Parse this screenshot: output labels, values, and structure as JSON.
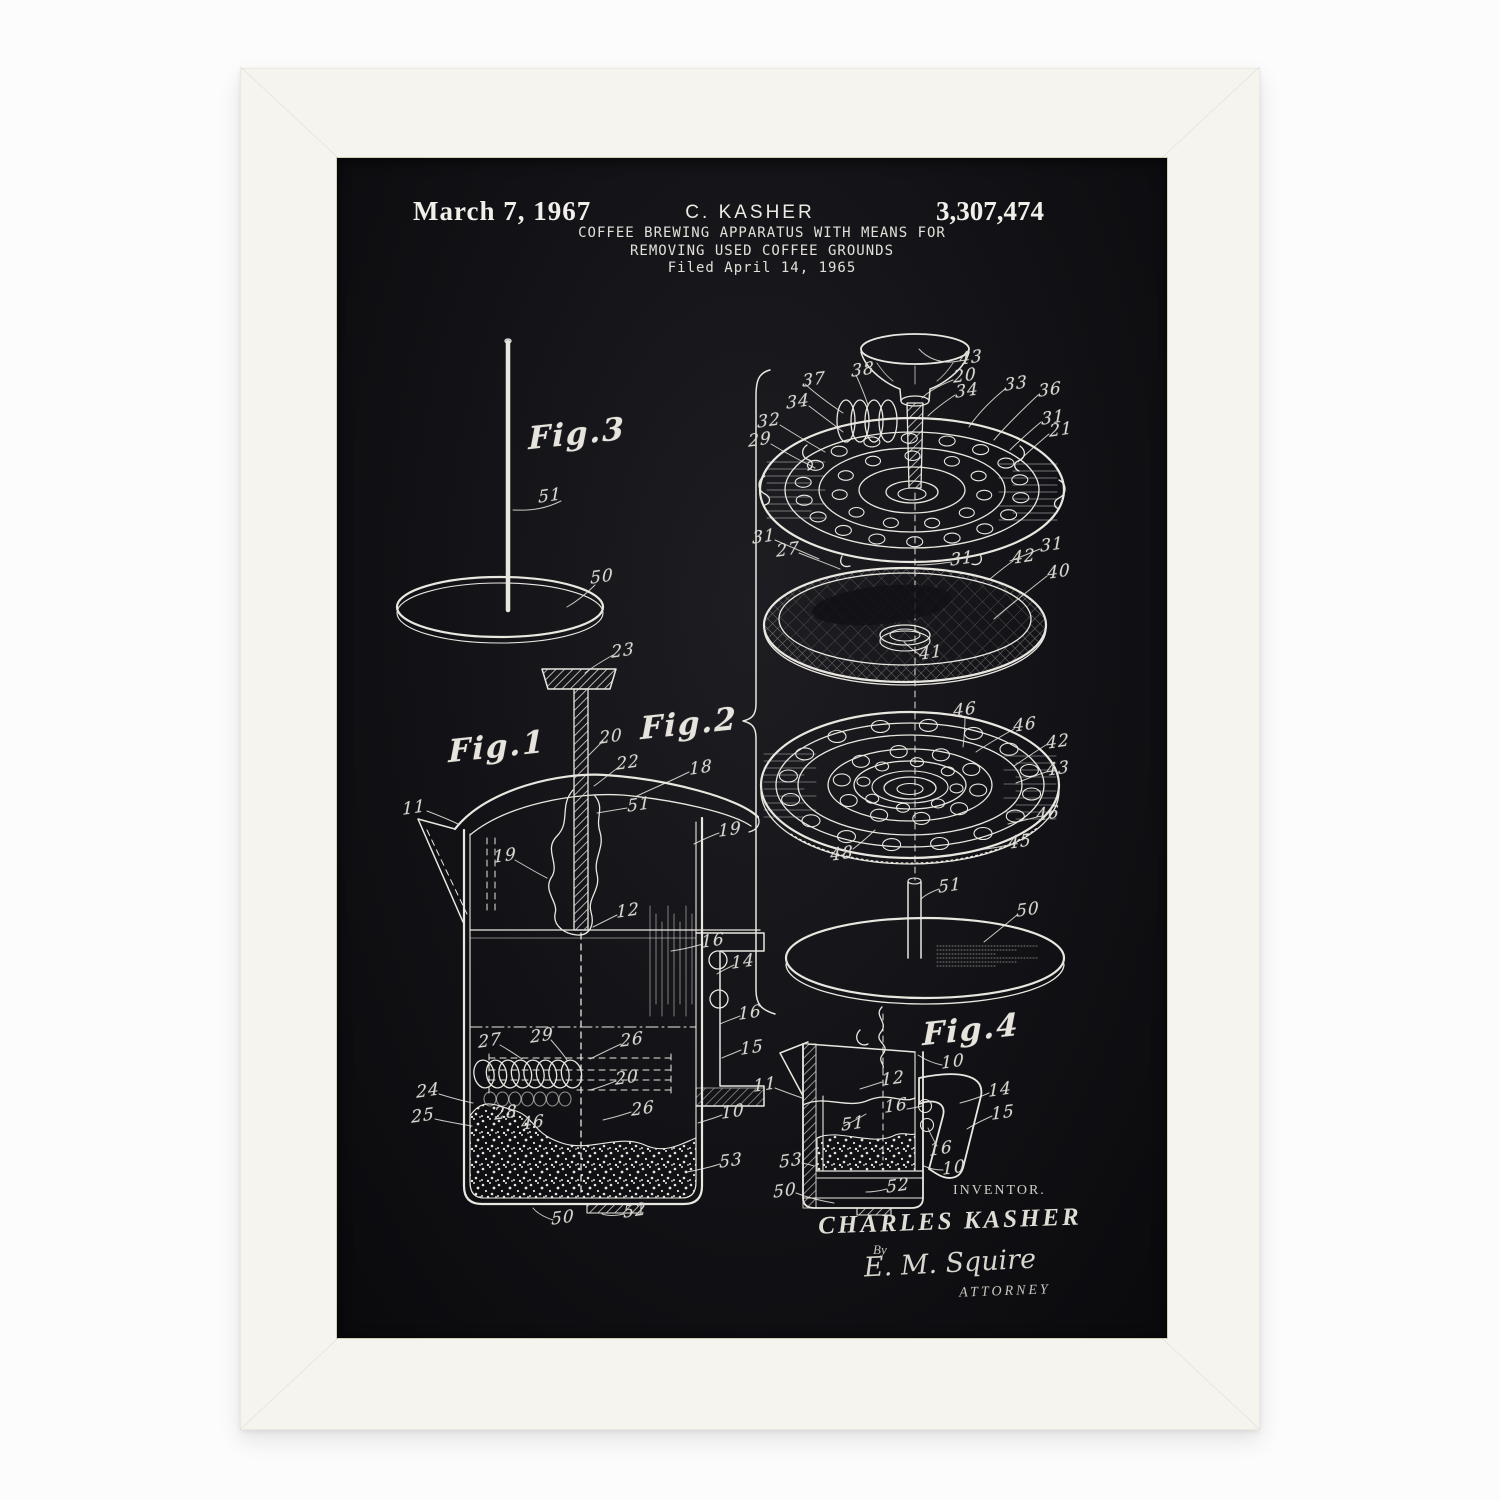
{
  "colors": {
    "page_bg": "#fcfcfc",
    "frame": "#f6f4ee",
    "poster_bg": "#101014",
    "line": "#e9e7e0"
  },
  "header": {
    "date": "March 7, 1967",
    "inventor": "C. KASHER",
    "patent_number": "3,307,474",
    "title_line1": "COFFEE BREWING APPARATUS WITH MEANS FOR",
    "title_line2": "REMOVING USED COFFEE GROUNDS",
    "filed": "Filed April 14, 1965"
  },
  "fig_captions": [
    {
      "text": "Fig.3",
      "x": 240,
      "y": 276
    },
    {
      "text": "Fig.1",
      "x": 160,
      "y": 589
    },
    {
      "text": "Fig.2",
      "x": 352,
      "y": 566
    },
    {
      "text": "Fig.4",
      "x": 634,
      "y": 872
    }
  ],
  "part_labels": [
    {
      "text": "51",
      "x": 213,
      "y": 338
    },
    {
      "text": "50",
      "x": 265,
      "y": 419
    },
    {
      "text": "23",
      "x": 286,
      "y": 493
    },
    {
      "text": "20",
      "x": 274,
      "y": 579
    },
    {
      "text": "22",
      "x": 291,
      "y": 605
    },
    {
      "text": "18",
      "x": 364,
      "y": 610
    },
    {
      "text": "11",
      "x": 77,
      "y": 650
    },
    {
      "text": "51",
      "x": 302,
      "y": 647
    },
    {
      "text": "19",
      "x": 168,
      "y": 698
    },
    {
      "text": "19",
      "x": 393,
      "y": 672
    },
    {
      "text": "12",
      "x": 291,
      "y": 753
    },
    {
      "text": "16",
      "x": 376,
      "y": 783
    },
    {
      "text": "14",
      "x": 406,
      "y": 804
    },
    {
      "text": "16",
      "x": 413,
      "y": 855
    },
    {
      "text": "15",
      "x": 415,
      "y": 890
    },
    {
      "text": "27",
      "x": 153,
      "y": 883
    },
    {
      "text": "29",
      "x": 205,
      "y": 878
    },
    {
      "text": "26",
      "x": 295,
      "y": 882
    },
    {
      "text": "20",
      "x": 290,
      "y": 920
    },
    {
      "text": "26",
      "x": 306,
      "y": 951
    },
    {
      "text": "24",
      "x": 91,
      "y": 933
    },
    {
      "text": "25",
      "x": 86,
      "y": 958
    },
    {
      "text": "28",
      "x": 169,
      "y": 955
    },
    {
      "text": "46",
      "x": 196,
      "y": 965
    },
    {
      "text": "10",
      "x": 396,
      "y": 954
    },
    {
      "text": "53",
      "x": 394,
      "y": 1003
    },
    {
      "text": "52",
      "x": 298,
      "y": 1053
    },
    {
      "text": "50",
      "x": 226,
      "y": 1060
    },
    {
      "text": "43",
      "x": 634,
      "y": 200
    },
    {
      "text": "38",
      "x": 526,
      "y": 212
    },
    {
      "text": "37",
      "x": 477,
      "y": 222
    },
    {
      "text": "20",
      "x": 628,
      "y": 218
    },
    {
      "text": "34",
      "x": 630,
      "y": 233
    },
    {
      "text": "33",
      "x": 679,
      "y": 226
    },
    {
      "text": "36",
      "x": 713,
      "y": 232
    },
    {
      "text": "34",
      "x": 461,
      "y": 244
    },
    {
      "text": "32",
      "x": 432,
      "y": 263
    },
    {
      "text": "29",
      "x": 423,
      "y": 282
    },
    {
      "text": "31",
      "x": 716,
      "y": 260
    },
    {
      "text": "21",
      "x": 724,
      "y": 272
    },
    {
      "text": "31",
      "x": 427,
      "y": 379
    },
    {
      "text": "27",
      "x": 451,
      "y": 392
    },
    {
      "text": "31",
      "x": 625,
      "y": 401
    },
    {
      "text": "31",
      "x": 715,
      "y": 387
    },
    {
      "text": "42",
      "x": 687,
      "y": 399
    },
    {
      "text": "40",
      "x": 722,
      "y": 414
    },
    {
      "text": "41",
      "x": 594,
      "y": 495
    },
    {
      "text": "46",
      "x": 628,
      "y": 552
    },
    {
      "text": "46",
      "x": 688,
      "y": 567
    },
    {
      "text": "42",
      "x": 721,
      "y": 584
    },
    {
      "text": "43",
      "x": 721,
      "y": 611
    },
    {
      "text": "46",
      "x": 711,
      "y": 656
    },
    {
      "text": "45",
      "x": 683,
      "y": 684
    },
    {
      "text": "48",
      "x": 505,
      "y": 696
    },
    {
      "text": "51",
      "x": 613,
      "y": 728
    },
    {
      "text": "50",
      "x": 691,
      "y": 752
    },
    {
      "text": "10",
      "x": 616,
      "y": 904
    },
    {
      "text": "12",
      "x": 556,
      "y": 921
    },
    {
      "text": "14",
      "x": 663,
      "y": 932
    },
    {
      "text": "15",
      "x": 666,
      "y": 955
    },
    {
      "text": "16",
      "x": 559,
      "y": 948
    },
    {
      "text": "51",
      "x": 516,
      "y": 966
    },
    {
      "text": "16",
      "x": 604,
      "y": 991
    },
    {
      "text": "10",
      "x": 617,
      "y": 1010
    },
    {
      "text": "11",
      "x": 428,
      "y": 927
    },
    {
      "text": "53",
      "x": 454,
      "y": 1003
    },
    {
      "text": "50",
      "x": 448,
      "y": 1033
    },
    {
      "text": "52",
      "x": 561,
      "y": 1028
    }
  ],
  "signature": {
    "inventor_caption": "INVENTOR.",
    "inventor_name": "CHARLES KASHER",
    "by": "By",
    "attorney_name": "E. M. Squire",
    "attorney_caption": "ATTORNEY"
  }
}
